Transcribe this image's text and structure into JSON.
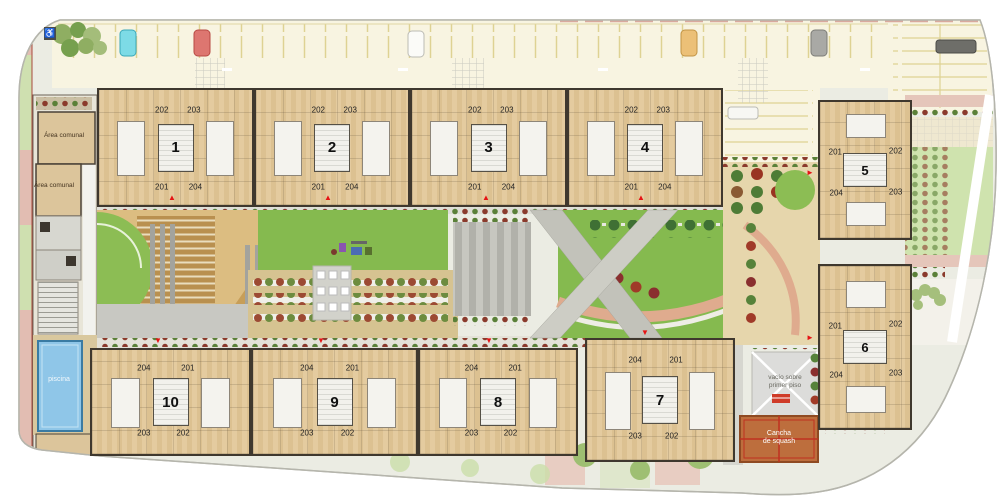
{
  "plan": {
    "buildings": [
      {
        "number": "1",
        "units": [
          "202",
          "203",
          "201",
          "204"
        ]
      },
      {
        "number": "2",
        "units": [
          "202",
          "203",
          "201",
          "204"
        ]
      },
      {
        "number": "3",
        "units": [
          "202",
          "203",
          "201",
          "204"
        ]
      },
      {
        "number": "4",
        "units": [
          "202",
          "203",
          "201",
          "204"
        ]
      },
      {
        "number": "5",
        "units": [
          "201",
          "202",
          "204",
          "203"
        ]
      },
      {
        "number": "6",
        "units": [
          "201",
          "202",
          "204",
          "203"
        ]
      },
      {
        "number": "7",
        "units": [
          "204",
          "201",
          "203",
          "202"
        ]
      },
      {
        "number": "8",
        "units": [
          "204",
          "201",
          "203",
          "202"
        ]
      },
      {
        "number": "9",
        "units": [
          "204",
          "201",
          "203",
          "202"
        ]
      },
      {
        "number": "10",
        "units": [
          "204",
          "201",
          "203",
          "202"
        ]
      }
    ],
    "labels": {
      "area_comunal_upper": "Área comunal",
      "area_comunal_lower": "Área comunal",
      "piscina": "piscina",
      "vacio_line1": "vacío sobre",
      "vacio_line2": "primer piso",
      "cancha_line1": "Cancha",
      "cancha_line2": "de squash"
    },
    "icons": {
      "accessible_parking": "♿",
      "arrow_up": "▲",
      "arrow_down": "▼",
      "arrow_right": "►"
    },
    "colors": {
      "lawn_green": "#85ba4f",
      "plaza_tan": "#d8b273",
      "building_tan": "#e2c89d",
      "pool_blue": "#8fc6e8",
      "squash_orange": "#bd6e3d",
      "parking_cream": "#f8f4e1",
      "accent_red": "#e51414"
    }
  }
}
